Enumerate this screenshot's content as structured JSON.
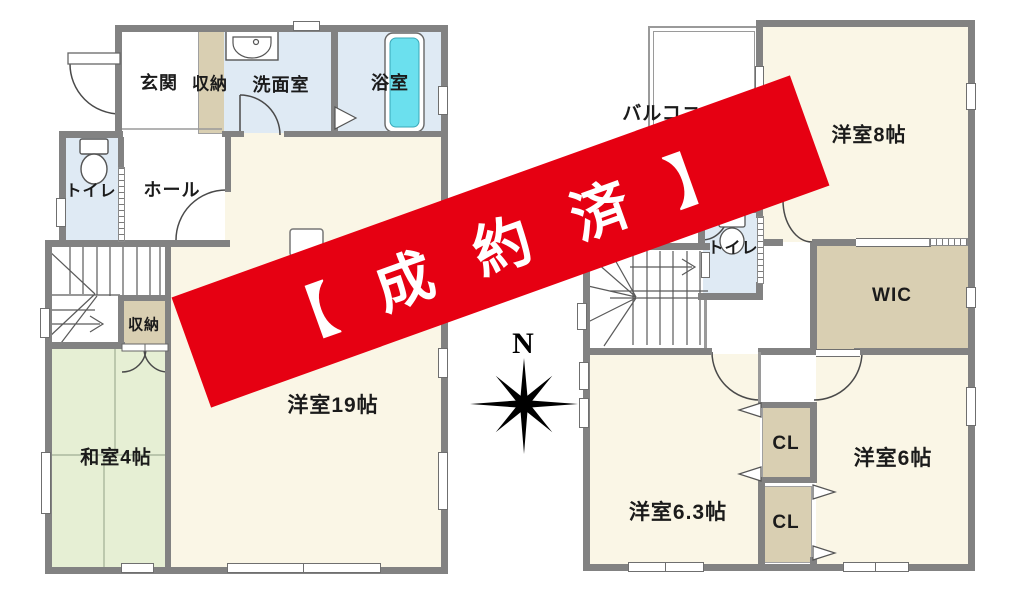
{
  "banner": {
    "text": "【成約済】"
  },
  "compass": {
    "north": "N"
  },
  "floor1": {
    "labels": {
      "genkan": "玄関",
      "shunou_top": "収納",
      "senmenshitsu": "洗面室",
      "yokushitsu": "浴室",
      "toire": "トイレ",
      "hooru": "ホール",
      "shunou_stairs": "収納",
      "washitsu": "和室4帖",
      "youshitsu19": "洋室19帖"
    }
  },
  "floor2": {
    "labels": {
      "balcony": "バルコニー",
      "youshitsu8": "洋室8帖",
      "toire": "トイレ",
      "wic": "WIC",
      "cl_upper": "CL",
      "cl_lower": "CL",
      "youshitsu6": "洋室6帖",
      "youshitsu63": "洋室6.3帖"
    }
  },
  "palette": {
    "wall": "#828282",
    "room_cream": "#faf6e6",
    "room_blue": "#dfeaf4",
    "room_tan": "#d9cfb2",
    "room_green": "#e6efd4",
    "tub": "#6be0ee",
    "banner_red": "#e60012"
  }
}
